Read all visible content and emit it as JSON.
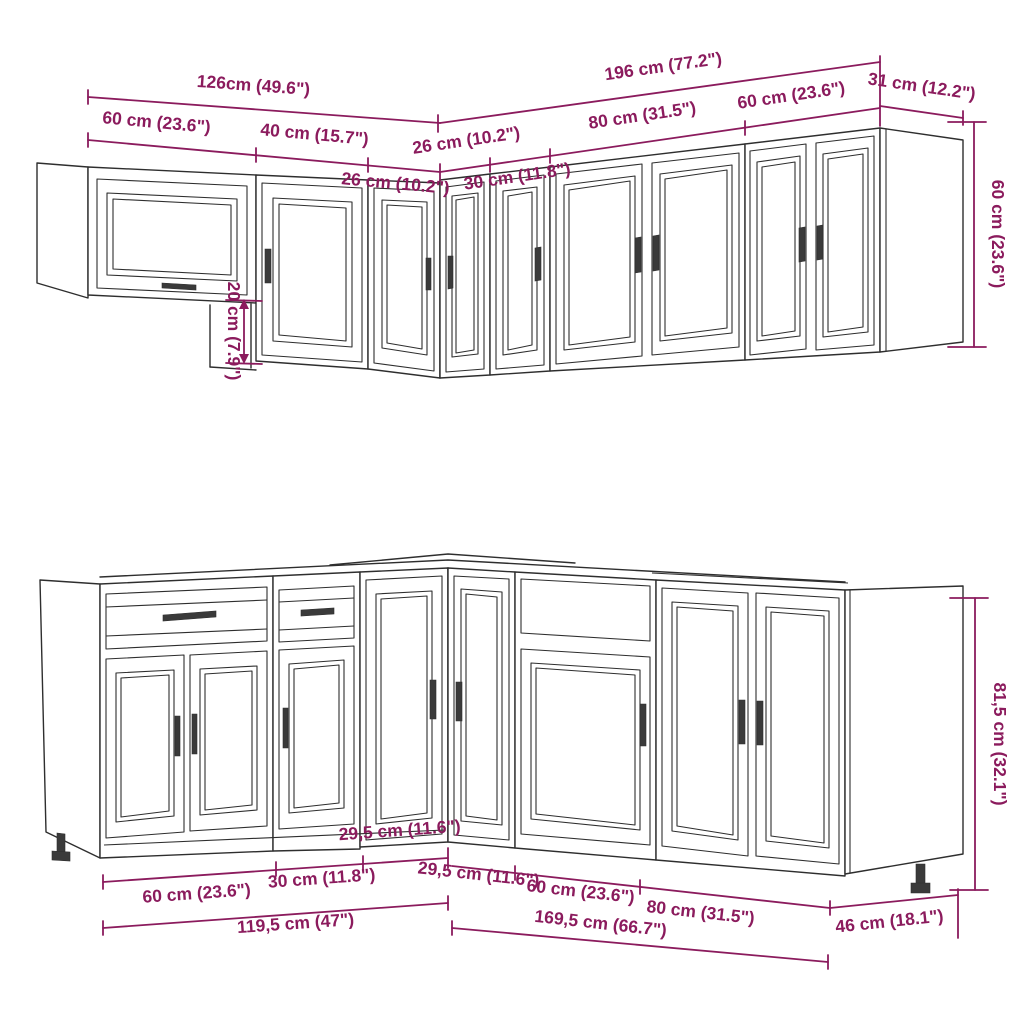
{
  "colors": {
    "dimension_accent": "#8b1b5d",
    "drawing_line": "#2e2e2e",
    "background": "#ffffff"
  },
  "diagram": {
    "subject": "11-piece L-shaped kitchen cabinet set dimension drawing",
    "upper": {
      "total_left": "126cm (49.6\")",
      "total_right": "196 cm (77.2\")",
      "seg_60_left": "60 cm (23.6\")",
      "seg_40": "40 cm (15.7\")",
      "seg_26_left": "26 cm (10.2\")",
      "seg_26_right": "26 cm (10.2\")",
      "seg_30": "30 cm (11.8\")",
      "seg_80": "80 cm (31.5\")",
      "seg_60_right": "60 cm (23.6\")",
      "side_depth": "31 cm (12.2\")",
      "height": "60 cm (23.6\")",
      "offset": "20 cm (7.9\")"
    },
    "lower": {
      "seg_60_left": "60 cm (23.6\")",
      "seg_30": "30 cm (11.8\")",
      "seg_295_left": "29,5 cm (11.6\")",
      "seg_295_right": "29,5 cm (11.6\")",
      "seg_60_right": "60 cm (23.6\")",
      "seg_80": "80 cm (31.5\")",
      "total_left": "119,5 cm (47\")",
      "total_right": "169,5 cm (66.7\")",
      "side_depth": "46 cm (18.1\")",
      "height": "81,5 cm (32.1\")"
    }
  }
}
